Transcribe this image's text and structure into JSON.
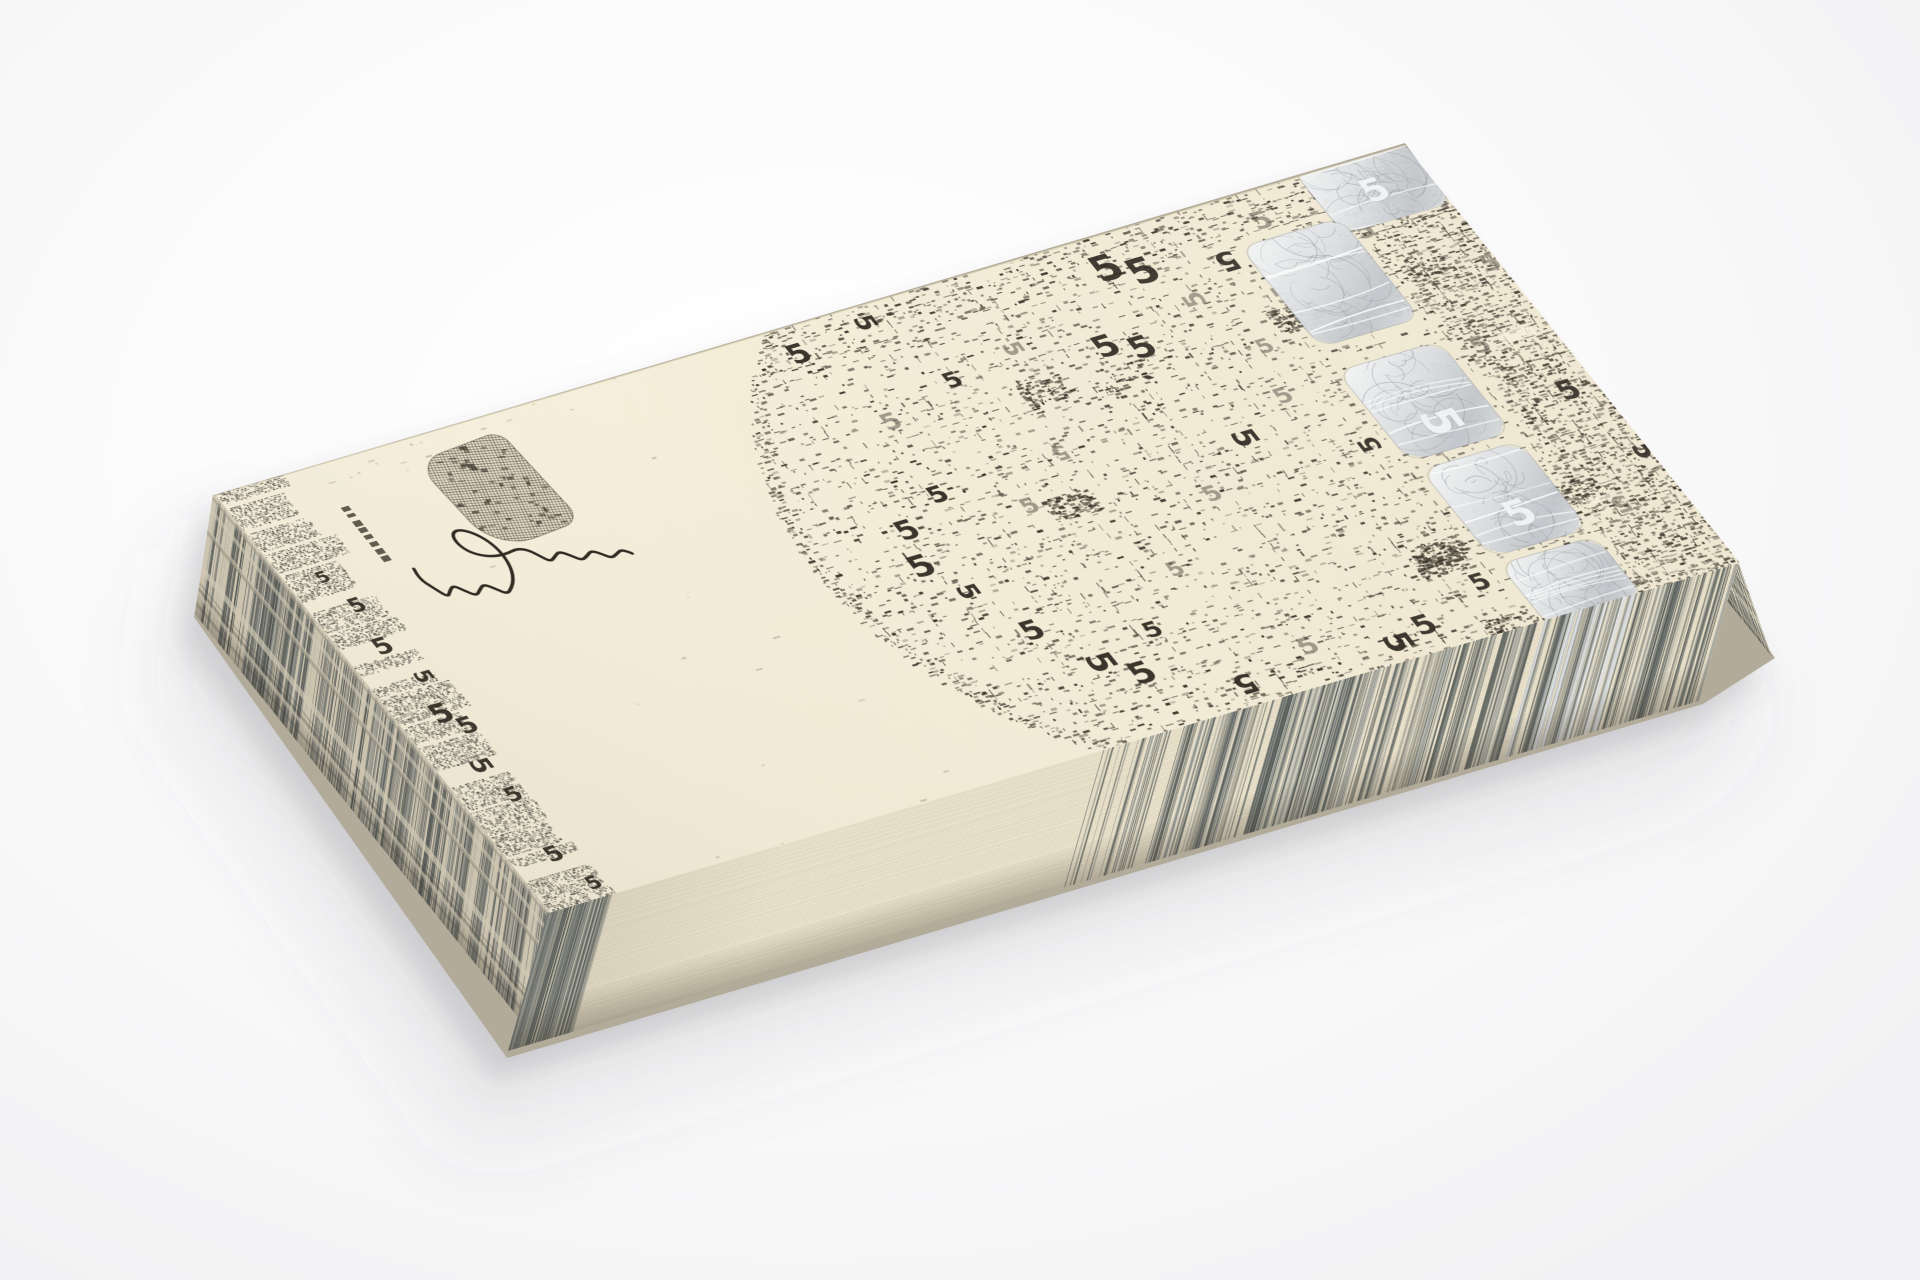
{
  "meta": {
    "title": "Stack of cream art banknotes printed with etched pattern, numeral 5, silver foil stripe, stamp and signature, photographed on a white background"
  },
  "scene": {
    "background": "#fafafa",
    "silhouette": "#b3ab99",
    "shadow_near": "rgba(88,88,96,0.20)",
    "shadow_far": "rgba(96,96,104,0.10)"
  },
  "note": {
    "denomination_numeral": "5",
    "paper_light": "#f7f1de",
    "paper_shade": "#eee6cf",
    "ink_dark": "#3a342a",
    "ink_mid": "#6e6759",
    "ink_light": "#9f9888",
    "five_dark": "#2a251d",
    "five_mid": "#5c564c",
    "silver_hi": "#f4f6f7",
    "silver": "#d9dcdf",
    "silver_lo": "#bfc3c8",
    "silver_line": "#878d94"
  },
  "edges": {
    "paper_edge": "#ece4cd",
    "line_color": "rgba(138,127,102,0.16)",
    "streak_colors": [
      "#49504f",
      "#5f6664",
      "#777d7c",
      "#8f9492",
      "#a6aaa7"
    ]
  },
  "artwork": {
    "seed": 7,
    "band_w": 64,
    "field_u": 660,
    "circle": {
      "cx": 810,
      "cy": 268,
      "r": 358
    },
    "foil": {
      "u": 1032,
      "w": 104,
      "patches": [
        {
          "u": 1128,
          "v": -10,
          "w": 116,
          "h": 84
        },
        {
          "u": 1032,
          "v": 56,
          "w": 104,
          "h": 128
        },
        {
          "u": 1030,
          "v": 214,
          "w": 106,
          "h": 116
        },
        {
          "u": 1034,
          "v": 342,
          "w": 102,
          "h": 112
        },
        {
          "u": 1036,
          "v": 464,
          "w": 100,
          "h": 80
        }
      ],
      "fives": [
        {
          "u": 1080,
          "v": 298,
          "s": 46,
          "r": 90,
          "t": "s"
        },
        {
          "u": 1088,
          "v": 420,
          "s": 40,
          "t": "s"
        },
        {
          "u": 1184,
          "v": 40,
          "s": 36,
          "t": "s"
        }
      ]
    },
    "stamp": {
      "u": 196,
      "v": 24,
      "w": 92,
      "h": 118
    },
    "tick": {
      "u": 98,
      "v": 52,
      "w": 8,
      "h": 70
    },
    "signature": {
      "ox": 116,
      "oy": 92,
      "su": 0.62,
      "sv": 0.66,
      "sh": 0.17,
      "color": "#241f17",
      "pts": [
        [
          4,
          68
        ],
        [
          0,
          86
        ],
        [
          10,
          106
        ],
        [
          20,
          124
        ],
        [
          28,
          114
        ],
        [
          39,
          103
        ],
        [
          49,
          114
        ],
        [
          60,
          125
        ],
        [
          71,
          114
        ],
        [
          82,
          104
        ],
        [
          94,
          115
        ],
        [
          104,
          125
        ],
        [
          116,
          114
        ],
        [
          127,
          100
        ],
        [
          137,
          78
        ],
        [
          141,
          50
        ],
        [
          136,
          25
        ],
        [
          123,
          7
        ],
        [
          107,
          0
        ],
        [
          94,
          7
        ],
        [
          90,
          24
        ],
        [
          96,
          41
        ],
        [
          110,
          51
        ],
        [
          128,
          54
        ],
        [
          148,
          50
        ],
        [
          166,
          42
        ],
        [
          180,
          46
        ],
        [
          189,
          58
        ],
        [
          198,
          70
        ],
        [
          209,
          61
        ],
        [
          220,
          52
        ],
        [
          232,
          61
        ],
        [
          242,
          71
        ],
        [
          254,
          63
        ],
        [
          265,
          54
        ],
        [
          276,
          62
        ],
        [
          285,
          70
        ],
        [
          296,
          63
        ],
        [
          306,
          56
        ],
        [
          315,
          61
        ],
        [
          320,
          67
        ]
      ]
    },
    "band_fives": [
      {
        "u": 46,
        "v": 160,
        "s": 22
      },
      {
        "u": 40,
        "v": 210,
        "s": 26
      },
      {
        "u": 52,
        "v": 252,
        "s": 22,
        "r": 90
      },
      {
        "u": 44,
        "v": 298,
        "s": 30
      },
      {
        "u": 58,
        "v": 318,
        "s": 26
      },
      {
        "u": 40,
        "v": 362,
        "s": 26,
        "r": 90
      },
      {
        "u": 50,
        "v": 404,
        "s": 22
      },
      {
        "u": 44,
        "v": 478,
        "s": 24
      },
      {
        "u": 58,
        "v": 520,
        "s": 20
      },
      {
        "u": 36,
        "v": 120,
        "s": 18
      }
    ],
    "fives": [
      {
        "u": 588,
        "v": 34,
        "s": 30
      },
      {
        "u": 663,
        "v": 20,
        "s": 26,
        "r": 90
      },
      {
        "u": 905,
        "v": 40,
        "s": 40
      },
      {
        "u": 934,
        "v": 54,
        "s": 40
      },
      {
        "u": 1012,
        "v": 64,
        "s": 30,
        "r": 180
      },
      {
        "u": 1068,
        "v": 36,
        "s": 28,
        "t": "m"
      },
      {
        "u": 1200,
        "v": 26,
        "s": 30,
        "r": 90
      },
      {
        "u": 1148,
        "v": 78,
        "s": 26,
        "t": "m"
      },
      {
        "u": 620,
        "v": 132,
        "s": 26,
        "t": "m"
      },
      {
        "u": 700,
        "v": 108,
        "s": 24
      },
      {
        "u": 770,
        "v": 92,
        "s": 24,
        "r": 90,
        "t": "m"
      },
      {
        "u": 852,
        "v": 120,
        "s": 34
      },
      {
        "u": 882,
        "v": 132,
        "s": 34
      },
      {
        "u": 960,
        "v": 96,
        "s": 26,
        "r": 270,
        "t": "m"
      },
      {
        "u": 1035,
        "v": 120,
        "s": 26,
        "t": "m"
      },
      {
        "u": 610,
        "v": 222,
        "s": 26
      },
      {
        "u": 680,
        "v": 262,
        "s": 24,
        "t": "m"
      },
      {
        "u": 742,
        "v": 212,
        "s": 22,
        "r": 180,
        "t": "m"
      },
      {
        "u": 905,
        "v": 255,
        "s": 30,
        "r": 90
      },
      {
        "u": 968,
        "v": 225,
        "s": 24,
        "t": "m"
      },
      {
        "u": 842,
        "v": 305,
        "s": 24,
        "t": "m"
      },
      {
        "u": 1010,
        "v": 300,
        "s": 26,
        "r": 270
      },
      {
        "u": 986,
        "v": 168,
        "s": 22,
        "t": "m"
      },
      {
        "u": 560,
        "v": 250,
        "s": 30
      },
      {
        "u": 548,
        "v": 292,
        "s": 34
      },
      {
        "u": 568,
        "v": 330,
        "s": 26,
        "r": 90
      },
      {
        "u": 598,
        "v": 392,
        "s": 30
      },
      {
        "u": 632,
        "v": 444,
        "s": 34,
        "r": 90
      },
      {
        "u": 662,
        "v": 470,
        "s": 34
      },
      {
        "u": 742,
        "v": 508,
        "s": 30,
        "r": 180
      },
      {
        "u": 820,
        "v": 492,
        "s": 26,
        "t": "m"
      },
      {
        "u": 896,
        "v": 514,
        "s": 34,
        "r": 90
      },
      {
        "u": 932,
        "v": 506,
        "s": 30
      },
      {
        "u": 1008,
        "v": 478,
        "s": 26
      },
      {
        "u": 1092,
        "v": 506,
        "s": 28,
        "r": 270,
        "t": "m"
      },
      {
        "u": 1120,
        "v": 168,
        "s": 30,
        "r": 90
      },
      {
        "u": 1168,
        "v": 232,
        "s": 26,
        "t": "m"
      },
      {
        "u": 1212,
        "v": 306,
        "s": 30
      },
      {
        "u": 1234,
        "v": 390,
        "s": 28,
        "r": 90
      },
      {
        "u": 1180,
        "v": 436,
        "s": 26,
        "r": 180,
        "t": "m"
      },
      {
        "u": 1232,
        "v": 150,
        "s": 26,
        "t": "m"
      },
      {
        "u": 760,
        "v": 372,
        "s": 22,
        "t": "m"
      },
      {
        "u": 700,
        "v": 428,
        "s": 24
      }
    ]
  }
}
